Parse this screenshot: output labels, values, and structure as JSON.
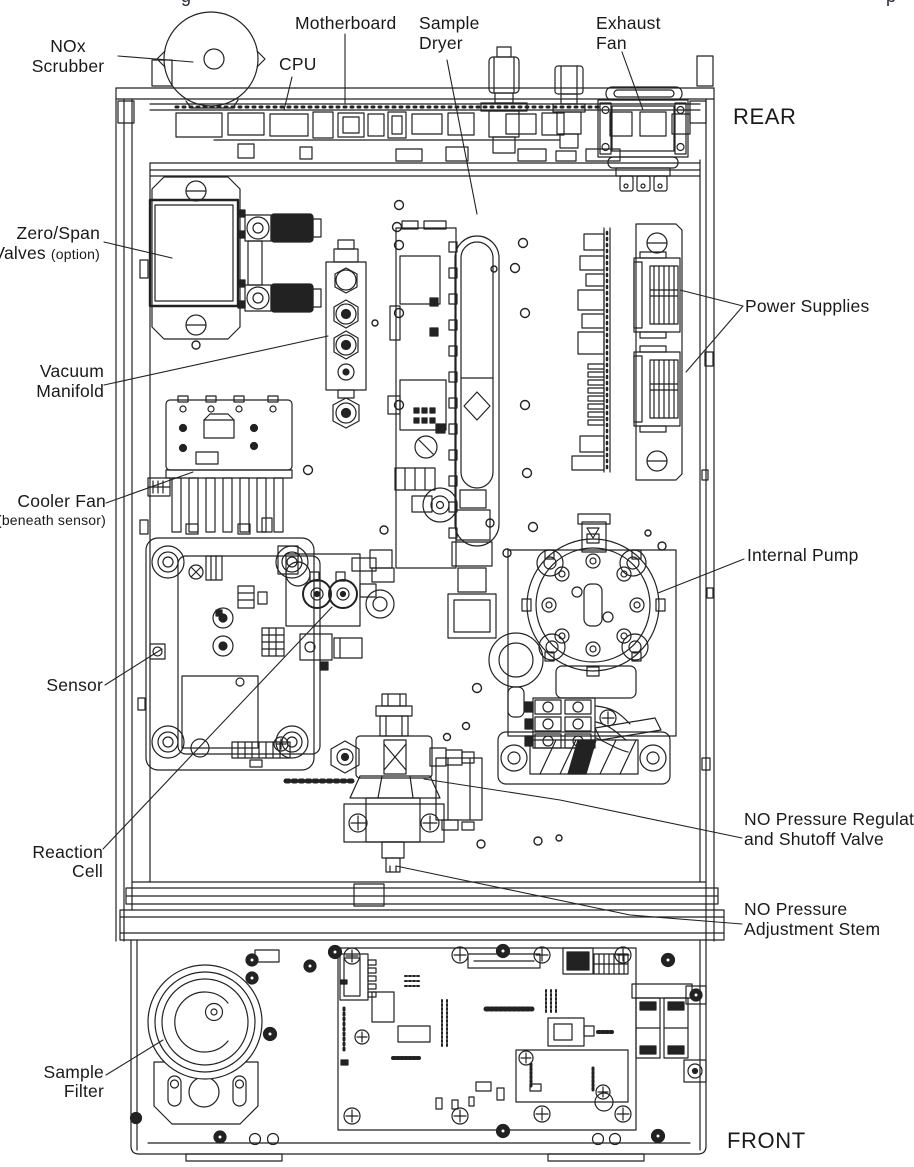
{
  "figure": {
    "caption_fragments": {
      "left": "g",
      "right": "p"
    }
  },
  "orientation_labels": {
    "rear": "REAR",
    "front": "FRONT"
  },
  "component_labels": {
    "nox_scrubber": {
      "line1": "NOx",
      "line2": "Scrubber"
    },
    "cpu": {
      "line1": "CPU"
    },
    "motherboard": {
      "line1": "Motherboard"
    },
    "sample_dryer": {
      "line1": "Sample",
      "line2": "Dryer"
    },
    "exhaust_fan": {
      "line1": "Exhaust",
      "line2": "Fan"
    },
    "zero_span_valves": {
      "line1": "Zero/Span",
      "line2_main": "Valves",
      "line2_note": "(option)"
    },
    "power_supplies": {
      "line1": "Power Supplies"
    },
    "vacuum_manifold": {
      "line1": "Vacuum",
      "line2": "Manifold"
    },
    "cooler_fan": {
      "line1": "Cooler Fan",
      "line2_note": "(beneath sensor)"
    },
    "internal_pump": {
      "line1": "Internal Pump"
    },
    "sensor": {
      "line1": "Sensor"
    },
    "reaction_cell": {
      "line1": "Reaction",
      "line2": "Cell"
    },
    "no_pressure_regulator_valve": {
      "line1": "NO Pressure Regulat",
      "line2": "and Shutoff Valve"
    },
    "no_pressure_adjustment_stem": {
      "line1": "NO Pressure",
      "line2": "Adjustment Stem"
    },
    "sample_filter": {
      "line1": "Sample",
      "line2": "Filter"
    }
  },
  "colors": {
    "line": "#222222",
    "background": "#ffffff",
    "label_text": "#1a1a1a"
  }
}
